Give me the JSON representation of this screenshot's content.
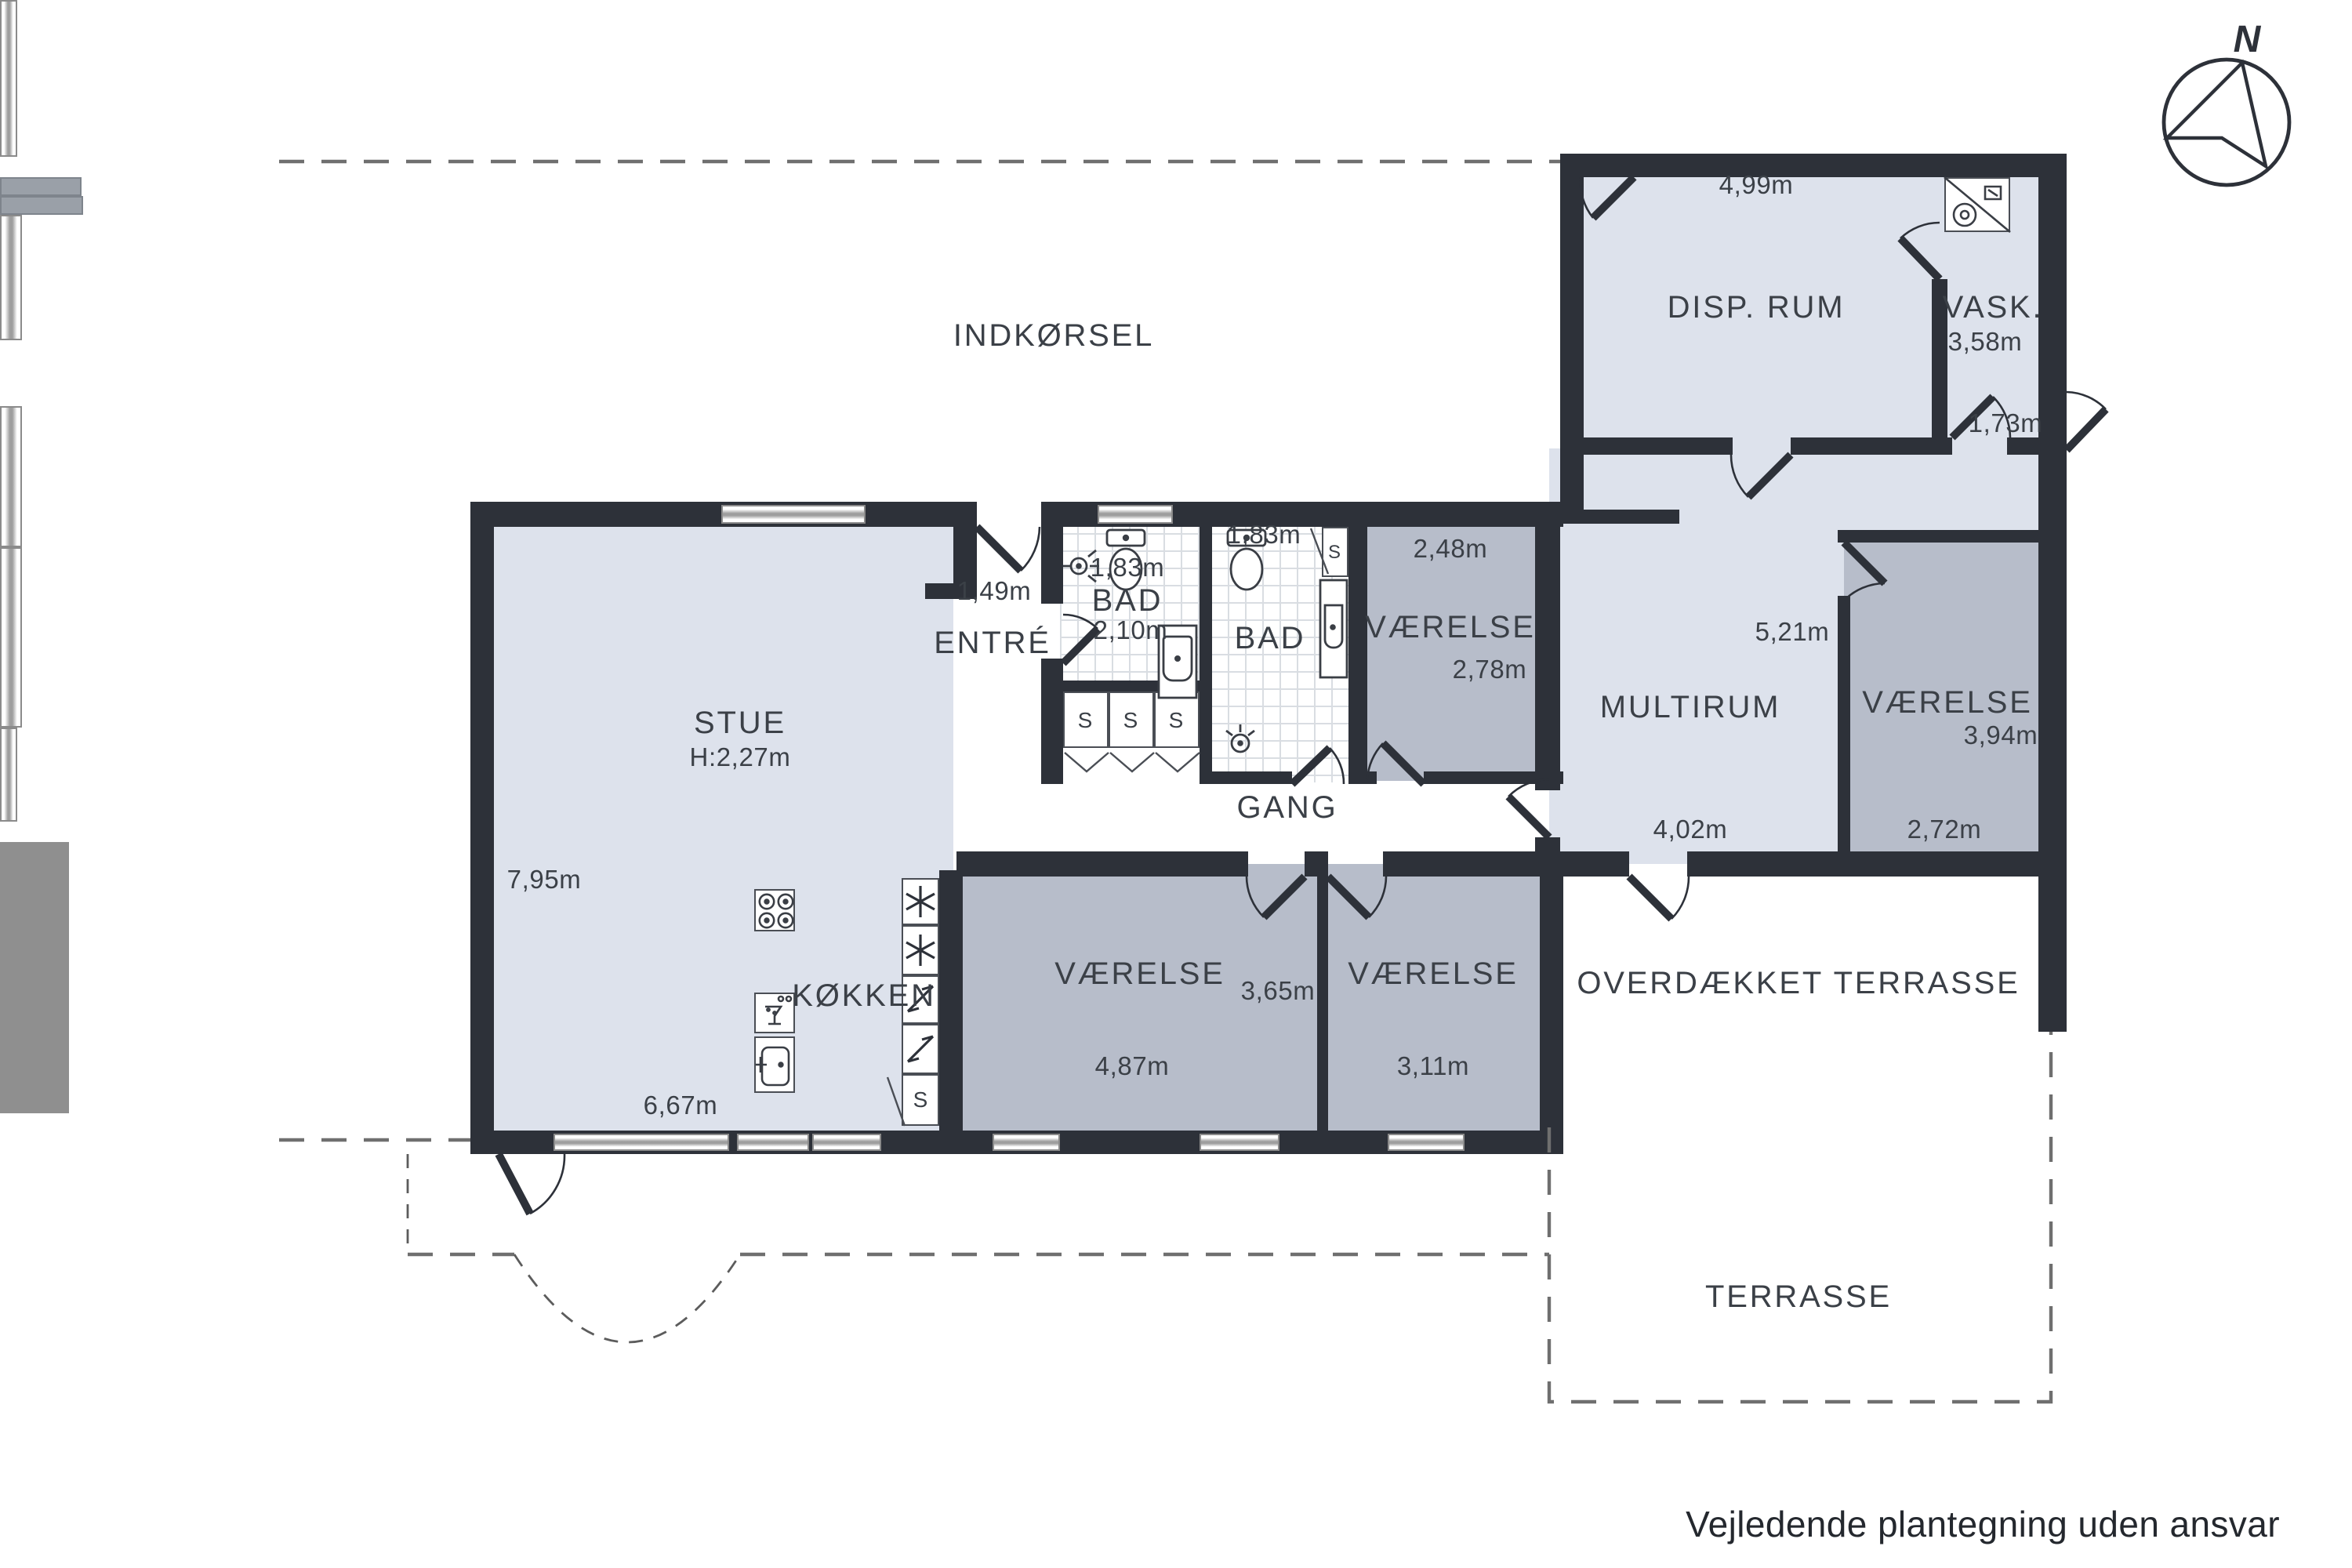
{
  "colors": {
    "wall": "#2d3139",
    "room_light": "#dde2ec",
    "room_dark": "#b7bdca",
    "kitchen_counter": "#8f8f8f",
    "text": "#3b4047"
  },
  "compass": {
    "label": "N"
  },
  "site": {
    "indkorsel": "INDKØRSEL",
    "overdaekket_terrasse": "OVERDÆKKET TERRASSE",
    "terrasse": "TERRASSE"
  },
  "rooms": {
    "stue": {
      "label": "STUE",
      "ceiling_height": "H:2,27m",
      "dim_left": "7,95m",
      "dim_bottom": "6,67m"
    },
    "kokken": {
      "label": "KØKKEN",
      "closet": "S"
    },
    "entre": {
      "label": "ENTRÉ",
      "door_dim": "1,49m"
    },
    "bad1": {
      "label": "BAD",
      "dim_top": "1,83m",
      "dim_mid": "2,10m",
      "closets": [
        "S",
        "S",
        "S"
      ]
    },
    "bad2": {
      "label": "BAD",
      "dim_top": "1,83m",
      "closet": "S"
    },
    "vaerelse_mid": {
      "label": "VÆRELSE",
      "dim_top": "2,48m",
      "dim_right": "2,78m"
    },
    "gang": {
      "label": "GANG"
    },
    "multirum": {
      "label": "MULTIRUM",
      "dim_right": "5,21m",
      "dim_bottom": "4,02m"
    },
    "disp_rum": {
      "label": "DISP. RUM",
      "dim_top": "4,99m"
    },
    "vask": {
      "label": "VASK.",
      "dim_mid": "3,58m",
      "dim_bottom": "1,73m"
    },
    "vaerelse_right": {
      "label": "VÆRELSE",
      "dim_right": "3,94m",
      "dim_bottom": "2,72m"
    },
    "vaerelse_b1": {
      "label": "VÆRELSE",
      "dim_right": "3,65m",
      "dim_bottom": "4,87m"
    },
    "vaerelse_b2": {
      "label": "VÆRELSE",
      "dim_bottom": "3,11m"
    }
  },
  "footer": {
    "disclaimer": "Vejledende plantegning uden ansvar"
  }
}
